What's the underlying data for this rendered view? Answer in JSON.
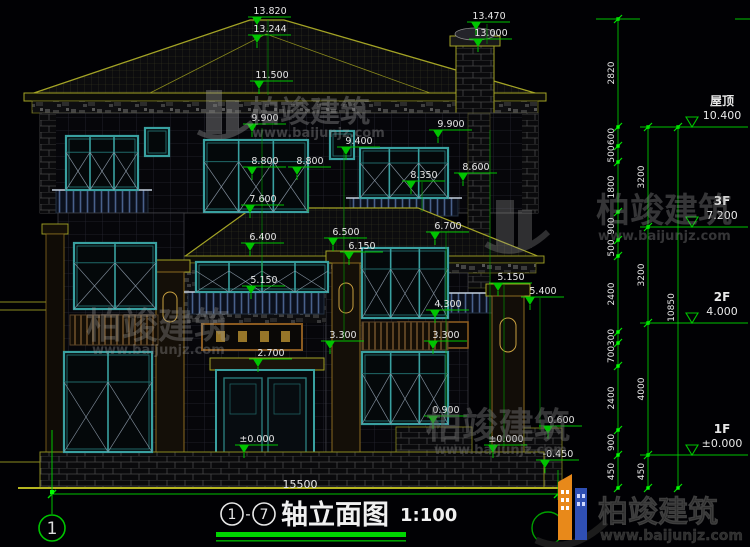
{
  "drawing": {
    "background": "#010104",
    "green": "#00c400",
    "yellow": "#9b9b1e",
    "text_white": "#e8e8e8",
    "teal": "#39a0a0",
    "title": {
      "axis_from": "1",
      "axis_to": "7",
      "name": "轴立面图",
      "scale": "1:100"
    },
    "bottom_axis_bubble": "1",
    "total_width_dim": "15500",
    "watermark": {
      "brand": "柏竣建筑",
      "url": "www.baijunjz.com"
    },
    "logo": {
      "brand": "柏竣建筑",
      "url": "www.baijunjz.com"
    },
    "right_levels": [
      {
        "label": "屋顶",
        "elev": "10.400",
        "y": 127
      },
      {
        "label": "3F",
        "elev": "7.200",
        "y": 227
      },
      {
        "label": "2F",
        "elev": "4.000",
        "y": 323
      },
      {
        "label": "1F",
        "elev": "±0.000",
        "y": 455
      }
    ],
    "dim_chains": [
      {
        "x": 618,
        "segments": [
          {
            "v": "2820",
            "y1": 19,
            "y2": 127
          },
          {
            "v": "600",
            "y1": 127,
            "y2": 146
          },
          {
            "v": "500",
            "y1": 146,
            "y2": 162
          },
          {
            "v": "1800",
            "y1": 162,
            "y2": 212
          },
          {
            "v": "900",
            "y1": 212,
            "y2": 240
          },
          {
            "v": "500",
            "y1": 240,
            "y2": 256
          },
          {
            "v": "2400",
            "y1": 256,
            "y2": 332
          },
          {
            "v": "300",
            "y1": 332,
            "y2": 343
          },
          {
            "v": "700",
            "y1": 343,
            "y2": 366
          },
          {
            "v": "2400",
            "y1": 366,
            "y2": 430
          },
          {
            "v": "900",
            "y1": 430,
            "y2": 455
          },
          {
            "v": "450",
            "y1": 455,
            "y2": 488
          }
        ]
      },
      {
        "x": 648,
        "segments": [
          {
            "v": "3200",
            "y1": 127,
            "y2": 227
          },
          {
            "v": "3200",
            "y1": 227,
            "y2": 323
          },
          {
            "v": "4000",
            "y1": 323,
            "y2": 455
          },
          {
            "v": "450",
            "y1": 455,
            "y2": 488
          }
        ]
      },
      {
        "x": 678,
        "segments": [
          {
            "v": "10850",
            "y1": 127,
            "y2": 488
          }
        ]
      }
    ],
    "elevation_markers": [
      {
        "v": "13.820",
        "x": 268,
        "y": 13
      },
      {
        "v": "13.244",
        "x": 268,
        "y": 31
      },
      {
        "v": "13.470",
        "x": 487,
        "y": 18
      },
      {
        "v": "13.000",
        "x": 489,
        "y": 35
      },
      {
        "v": "11.500",
        "x": 270,
        "y": 77
      },
      {
        "v": "9.900",
        "x": 263,
        "y": 120
      },
      {
        "v": "9.900",
        "x": 449,
        "y": 126
      },
      {
        "v": "9.400",
        "x": 357,
        "y": 143
      },
      {
        "v": "8.800",
        "x": 263,
        "y": 163
      },
      {
        "v": "8.800",
        "x": 308,
        "y": 163
      },
      {
        "v": "8.350",
        "x": 422,
        "y": 177
      },
      {
        "v": "8.600",
        "x": 474,
        "y": 169
      },
      {
        "v": "7.600",
        "x": 261,
        "y": 201
      },
      {
        "v": "6.400",
        "x": 261,
        "y": 239
      },
      {
        "v": "6.500",
        "x": 344,
        "y": 234
      },
      {
        "v": "6.150",
        "x": 360,
        "y": 248
      },
      {
        "v": "6.700",
        "x": 446,
        "y": 228
      },
      {
        "v": "5.150",
        "x": 262,
        "y": 282
      },
      {
        "v": "5.150",
        "x": 509,
        "y": 279
      },
      {
        "v": "5.400",
        "x": 541,
        "y": 293
      },
      {
        "v": "4.300",
        "x": 446,
        "y": 306
      },
      {
        "v": "3.300",
        "x": 341,
        "y": 337
      },
      {
        "v": "3.300",
        "x": 444,
        "y": 337
      },
      {
        "v": "2.700",
        "x": 269,
        "y": 355
      },
      {
        "v": "0.900",
        "x": 444,
        "y": 412
      },
      {
        "v": "0.600",
        "x": 559,
        "y": 422
      },
      {
        "v": "±0.000",
        "x": 255,
        "y": 441
      },
      {
        "v": "±0.000",
        "x": 504,
        "y": 441
      },
      {
        "v": "-0.450",
        "x": 556,
        "y": 456
      }
    ],
    "leader_lines": [
      {
        "x": 268,
        "y1": 20,
        "y2": 95
      },
      {
        "x": 487,
        "y1": 24,
        "y2": 44
      },
      {
        "x": 262,
        "y1": 128,
        "y2": 288
      },
      {
        "x": 308,
        "y1": 170,
        "y2": 212
      },
      {
        "x": 344,
        "y1": 150,
        "y2": 340
      },
      {
        "x": 446,
        "y1": 232,
        "y2": 414
      },
      {
        "x": 490,
        "y1": 130,
        "y2": 455
      },
      {
        "x": 504,
        "y1": 284,
        "y2": 448
      },
      {
        "x": 540,
        "y1": 298,
        "y2": 430
      },
      {
        "x": 422,
        "y1": 182,
        "y2": 212
      }
    ]
  }
}
